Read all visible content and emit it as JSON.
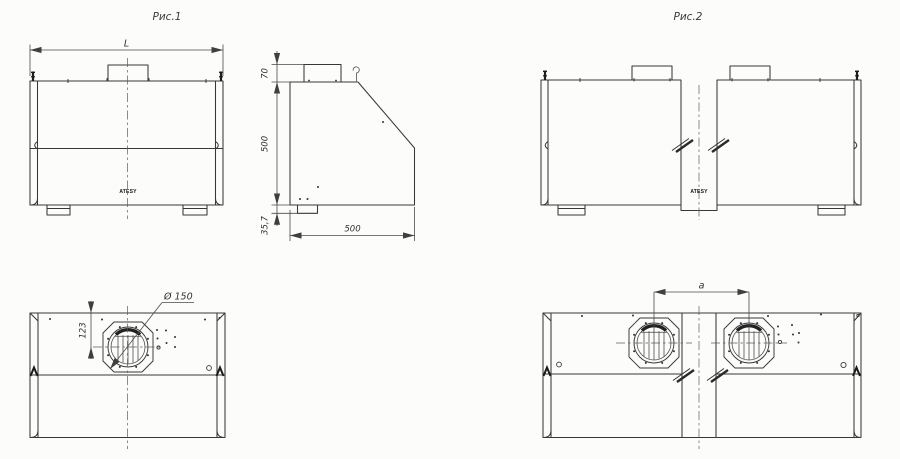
{
  "figure1": {
    "title": "Рис.1",
    "brand_label": "ATESY",
    "dims": {
      "overall_width": "L",
      "collar_height": "70",
      "body_height": "500",
      "foot_height": "35,7",
      "depth": "500",
      "duct_center_offset": "123",
      "duct_diameter": "Ø 150"
    }
  },
  "figure2": {
    "title": "Рис.2",
    "brand_label": "ATESY",
    "dims": {
      "duct_spacing": "a"
    }
  },
  "colors": {
    "line": "#383838",
    "dimension": "#4a4a4a",
    "background": "#fcfcfb"
  }
}
